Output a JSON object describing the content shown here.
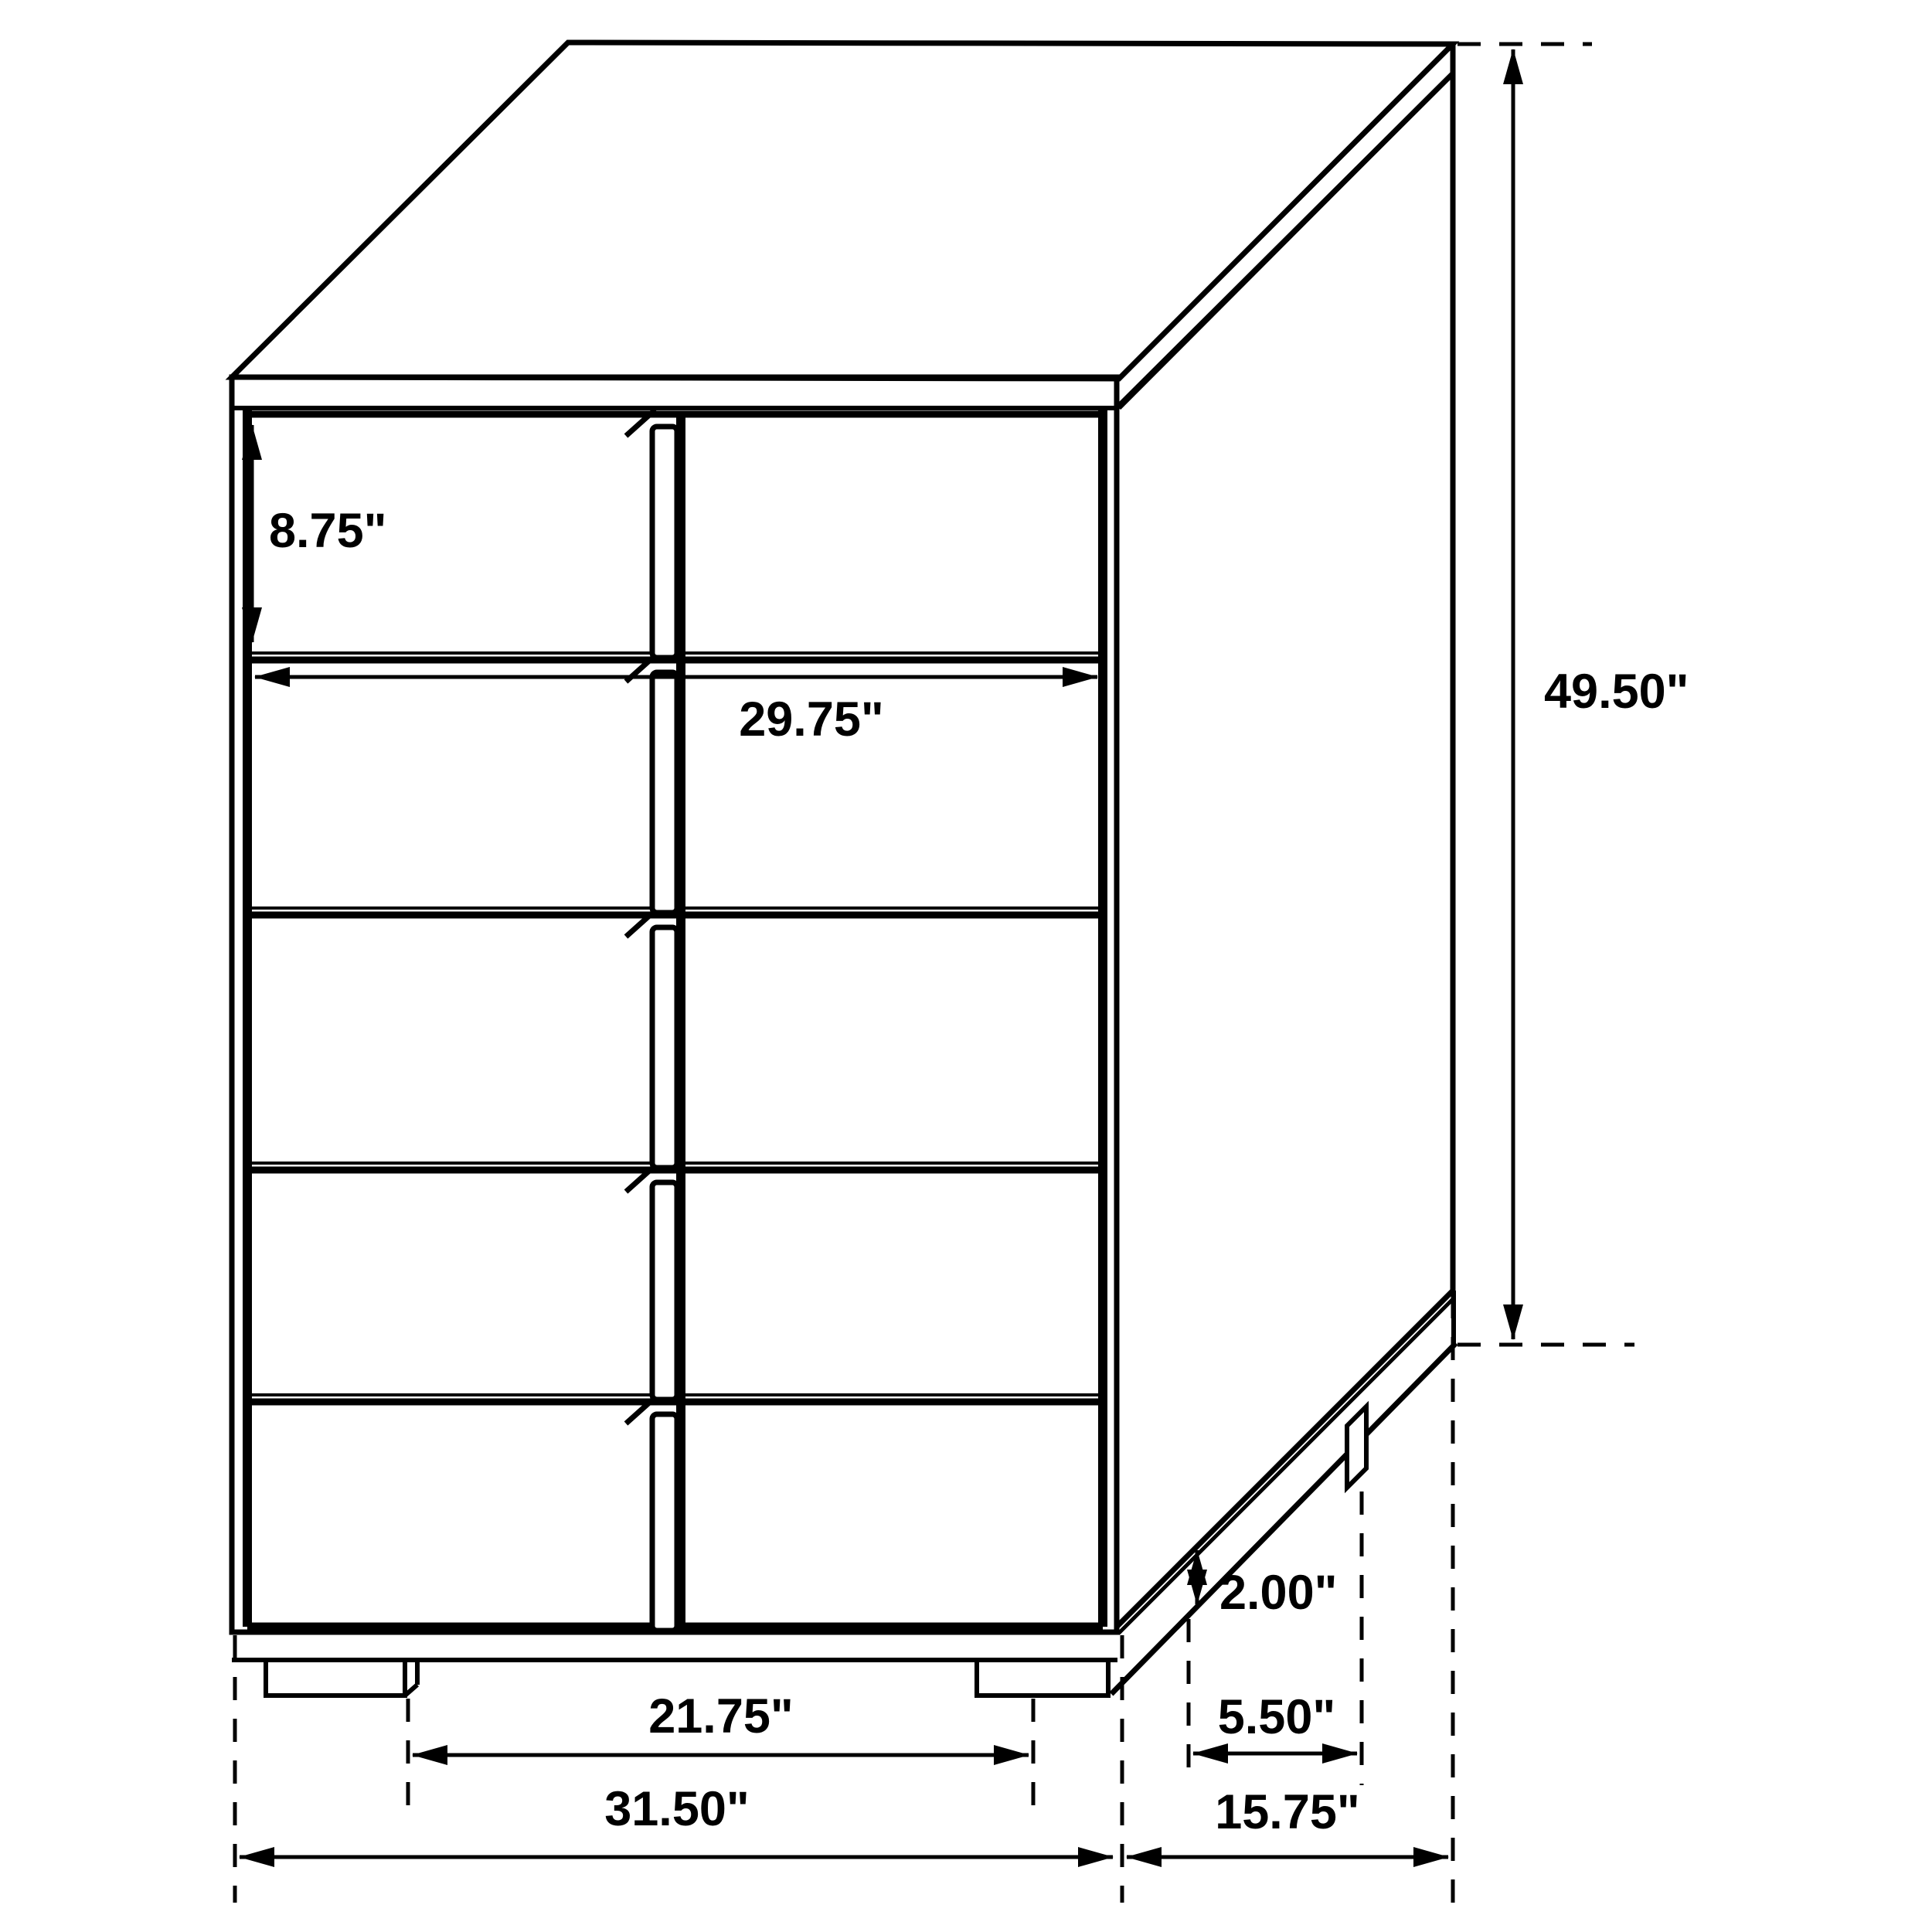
{
  "page": {
    "background_color": "#ffffff",
    "line_color": "#000000"
  },
  "diagram": {
    "kind": "furniture dimension line drawing",
    "item": "5-drawer chest, two-column drawer fronts with center vertical pulls",
    "units": "inches",
    "labels": {
      "top_drawer_height": "8.75\"",
      "drawer_width": "29.75\"",
      "overall_height": "49.50\"",
      "base_height": "2.00\"",
      "side_foot_setback": "5.50\"",
      "front_feet_span": "21.75\"",
      "overall_width": "31.50\"",
      "overall_depth": "15.75\""
    }
  }
}
